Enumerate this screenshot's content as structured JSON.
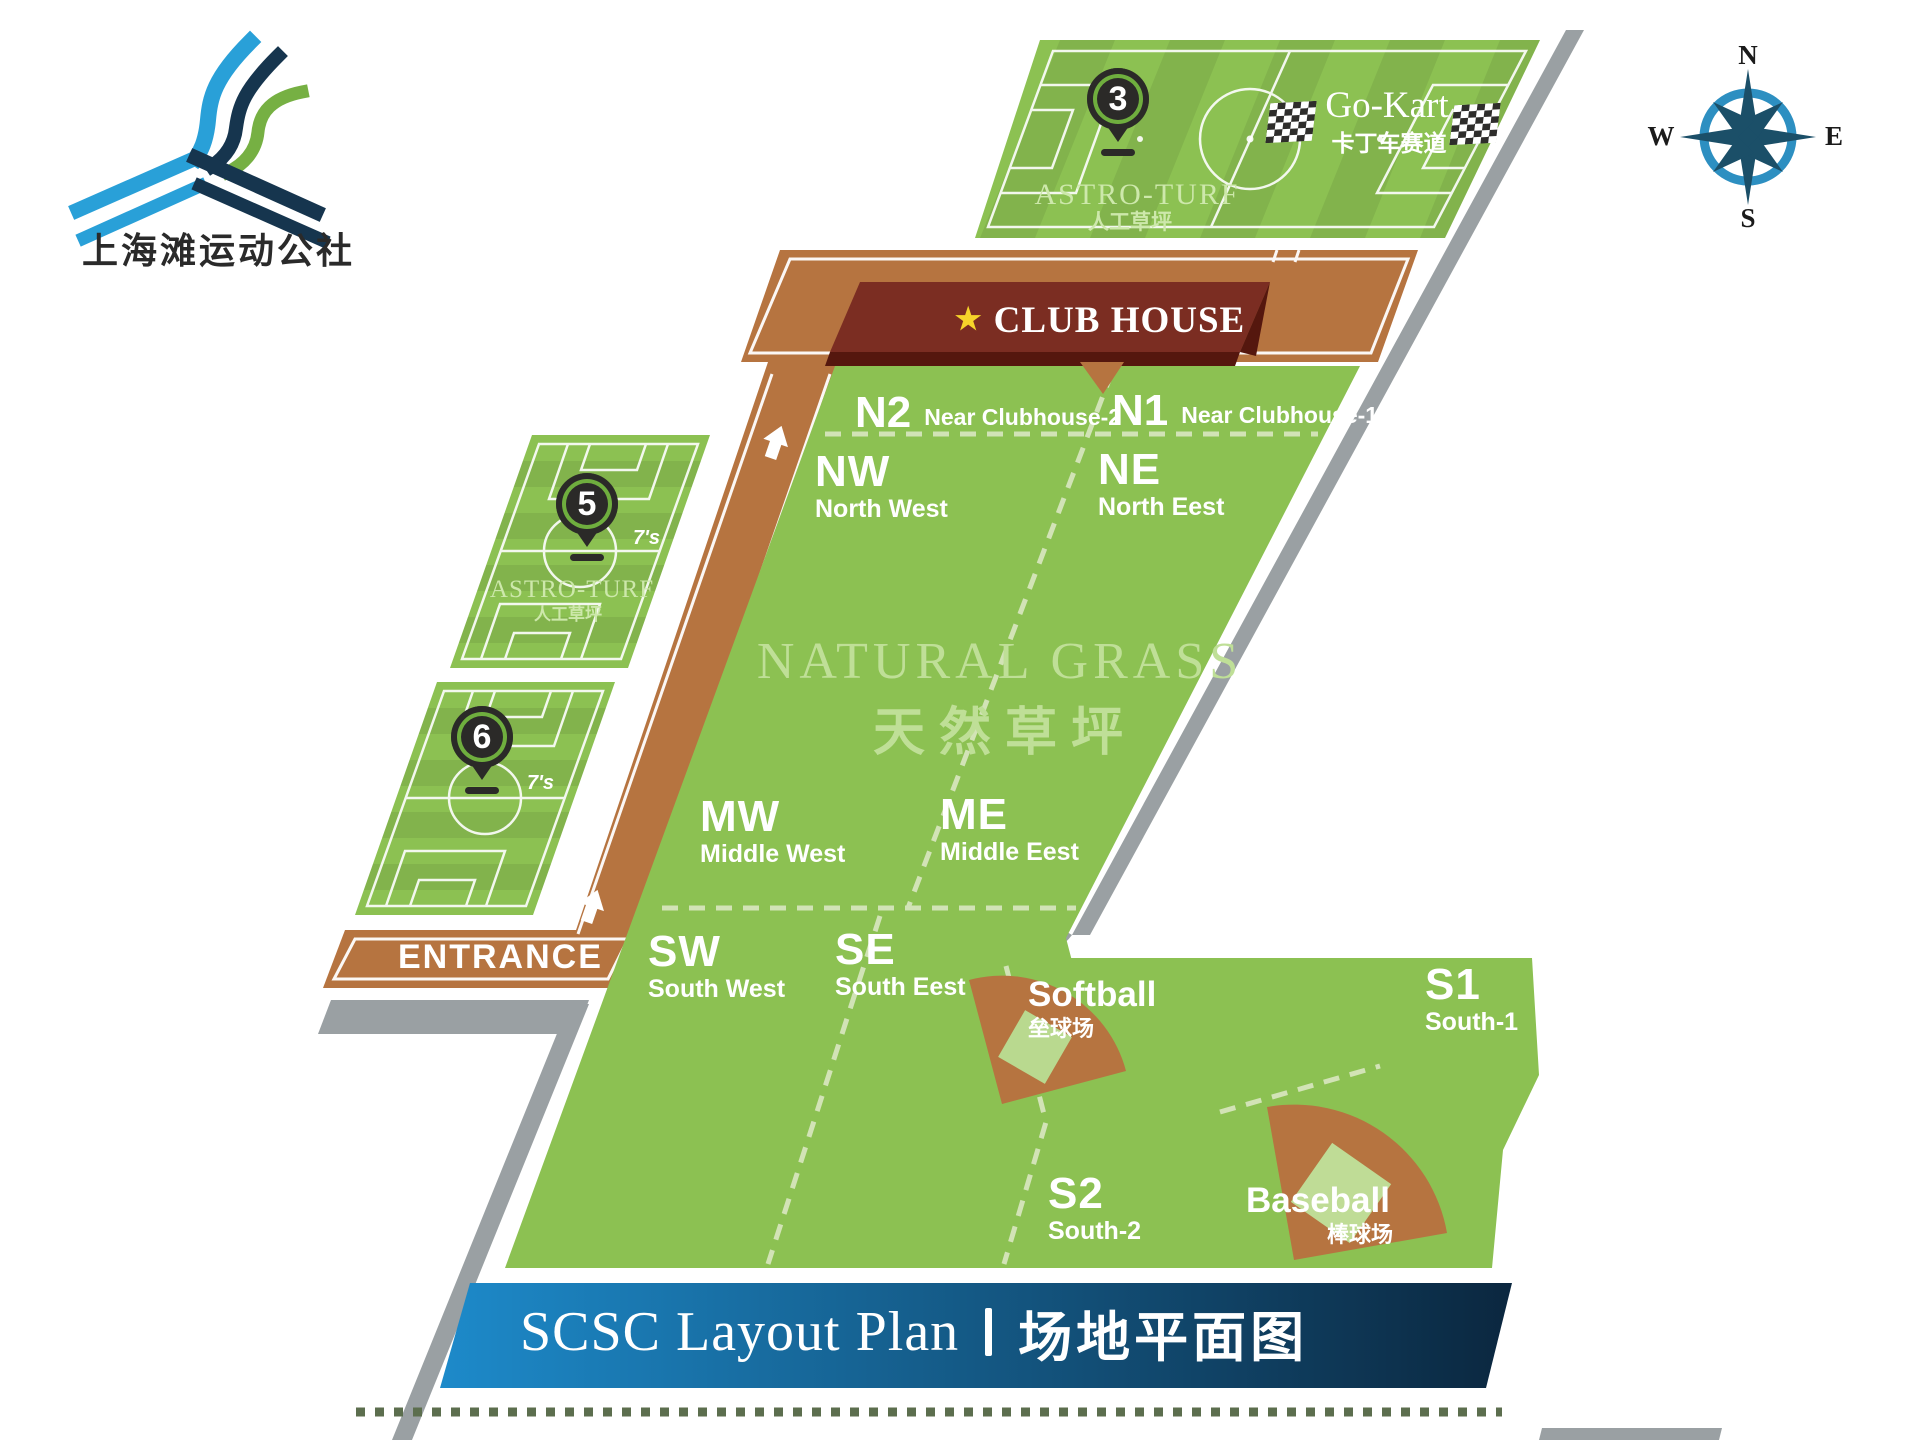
{
  "logo": {
    "name_cn": "上海滩运动公社"
  },
  "compass": {
    "n": "N",
    "e": "E",
    "s": "S",
    "w": "W"
  },
  "top_field": {
    "marker": "3",
    "surface": "ASTRO-TURF",
    "surface_cn": "人工草坪",
    "gokart": "Go-Kart",
    "gokart_cn": "卡丁车赛道"
  },
  "clubhouse": {
    "star": "★",
    "label": "CLUB HOUSE"
  },
  "natural_grass": {
    "title": "NATURAL GRASS",
    "title_cn": "天然草坪"
  },
  "sections": {
    "n2": {
      "code": "N2",
      "name": "Near Clubhouse-2"
    },
    "n1": {
      "code": "N1",
      "name": "Near Clubhouse-1"
    },
    "nw": {
      "code": "NW",
      "name": "North West"
    },
    "ne": {
      "code": "NE",
      "name": "North Eest"
    },
    "mw": {
      "code": "MW",
      "name": "Middle West"
    },
    "me": {
      "code": "ME",
      "name": "Middle Eest"
    },
    "sw": {
      "code": "SW",
      "name": "South West"
    },
    "se": {
      "code": "SE",
      "name": "South Eest"
    },
    "s1": {
      "code": "S1",
      "name": "South-1"
    },
    "s2": {
      "code": "S2",
      "name": "South-2"
    }
  },
  "west_fields": {
    "field5": {
      "marker": "5",
      "size": "7's",
      "surface": "ASTRO-TURF",
      "surface_cn": "人工草坪"
    },
    "field6": {
      "marker": "6",
      "size": "7's"
    }
  },
  "entrance": {
    "label": "ENTRANCE"
  },
  "softball": {
    "label": "Softball",
    "label_cn": "垒球场"
  },
  "baseball": {
    "label": "Baseball",
    "label_cn": "棒球场"
  },
  "banner": {
    "title_en": "SCSC Layout Plan",
    "title_cn": "场地平面图"
  },
  "colors": {
    "grass": "#8cc152",
    "road": "#b67440",
    "clubhouse_sign": "#7b2d22",
    "banner_start": "#1d8aca",
    "banner_end": "#0b273f",
    "gray_band": "#9aa0a3",
    "pin": "#2b2a28",
    "pin_ring": "#6fae3e",
    "compass_blue": "#2d8fc1",
    "star": "#f6d42a",
    "watermark_green": "#bfdf97"
  }
}
